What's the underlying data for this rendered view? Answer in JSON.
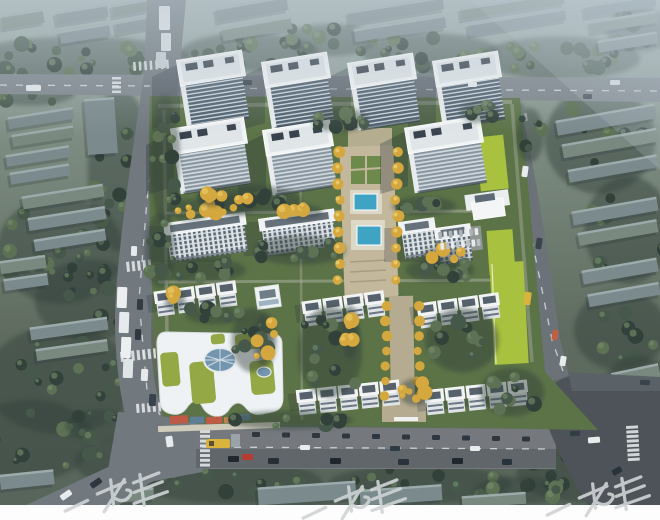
{
  "image": {
    "kind": "aerial architectural rendering",
    "label": "Bird's-eye rendering of a residential development: seven white high-rise towers, mid-rise slabs, townhouse rows, a kindergarten with green roofs and oval skylight, a central landscaped axis with two blue pools and golden trees, bordered by gray city roads with cars and buses"
  },
  "watermark": {
    "text": "一老生",
    "color": "#cfd3d5",
    "note": "diagonal gray watermark repeated three times along the bottom edge, partially cut off"
  },
  "scene": {
    "residential_towers": 7,
    "midrise_buildings": 4,
    "townhouse_rows": 5,
    "swimming_pools": 2,
    "kindergarten": "white curved building with green roof gardens, oval glass skylight and colorful playground",
    "linear_park": "lime-green strips along east edge",
    "roads": [
      "top boulevard",
      "left avenue",
      "bottom main road",
      "right avenue",
      "south-east junction"
    ],
    "vehicles": [
      "white buses queued on left avenue",
      "yellow bus at stop",
      "red car",
      "cars and trucks on all roads"
    ]
  },
  "palette": {
    "haze": "#bcc9d2",
    "ground-top": "#a3b2b0",
    "ground-mid": "#7c8b80",
    "ground-low": "#5e6b5e",
    "tree-dark": "#32413a",
    "tree-mid": "#46584a",
    "tree-light": "#5d7254",
    "ctx-roof": "#7b8a8c",
    "ctx-roof2": "#79897f",
    "ctx-hi": "#a2b0b2",
    "road": "#71787e",
    "road-light": "#7e858b",
    "asphalt-dark": "#4d5358",
    "lane": "#e8ecee",
    "site-green": "#5c7347",
    "lime": "#a8c13f",
    "plaza-tan": "#c3b79c",
    "path-tan": "#b5ab90",
    "pool-blue": "#3fa3c4",
    "tower-wall": "#eff2f4",
    "tower-roof": "#f1f4f5",
    "roof-dark": "#39434d",
    "glass-dark": "#4e5f6f",
    "floor-light": "#d3dade",
    "yellow-tree": "#d4a83e",
    "yellow-hi": "#eccf6e",
    "kinder-green": "#94a845",
    "skylight": "#7495af",
    "play-red": "#bf5a47",
    "play-blue": "#5d7e96",
    "play-orange": "#c9894f",
    "shadow": "#232e38",
    "bus-yellow": "#d8b43c",
    "car-red": "#b63c30",
    "white": "#ffffff",
    "wm-gray": "#cfd3d5"
  }
}
